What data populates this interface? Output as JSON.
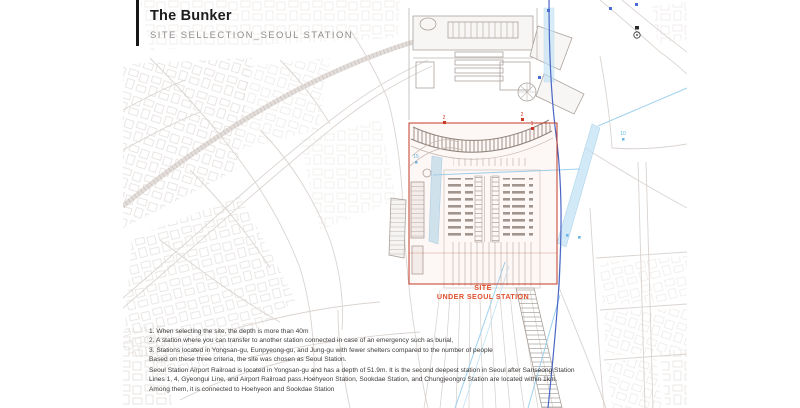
{
  "header": {
    "title": "The Bunker",
    "subtitle": "SITE SELLECTION_SEOUL STATION"
  },
  "site_overlay": {
    "label_line1": "SITE",
    "label_line2": "UNDER SEOUL STATION"
  },
  "criteria": {
    "lines": [
      "1. When selecting the site, the depth is more than 40m",
      "2. A station where you can transfer to another station connected in case of an emergency such as burial,",
      "3. Stations located in Yongsan-gu, Eunpyeong-gu, and Jung-gu with fewer shelters compared to the number of people",
      "Based on these three criteria, the site was chosen as Seoul Station."
    ]
  },
  "description": {
    "lines": [
      "Seoul Station Airport Railroad is located in Yongsan-gu and has a depth of 51.9m. It is the second deepest station in Seoul after Sanseong Station",
      "Lines 1, 4, Gyeongui Line, and Airport Railroad pass.Hoehyeon Station, Sookdae Station, and Chungjeongro Station are located within 1km.",
      "Among them, it is connected to Hoehyeon and Sookdae Station"
    ]
  },
  "map_markers": {
    "blue_15": "15",
    "blue_10": "10",
    "red_a": "2",
    "red_b": "2",
    "red_c": "1"
  },
  "colors": {
    "site_box_red": "#c23b28",
    "site_label_red": "#e0502f",
    "rail_blue": "#4a66c4",
    "airport_rail_blue": "#9ed2ef",
    "map_line_gray": "#d8d2ce"
  }
}
